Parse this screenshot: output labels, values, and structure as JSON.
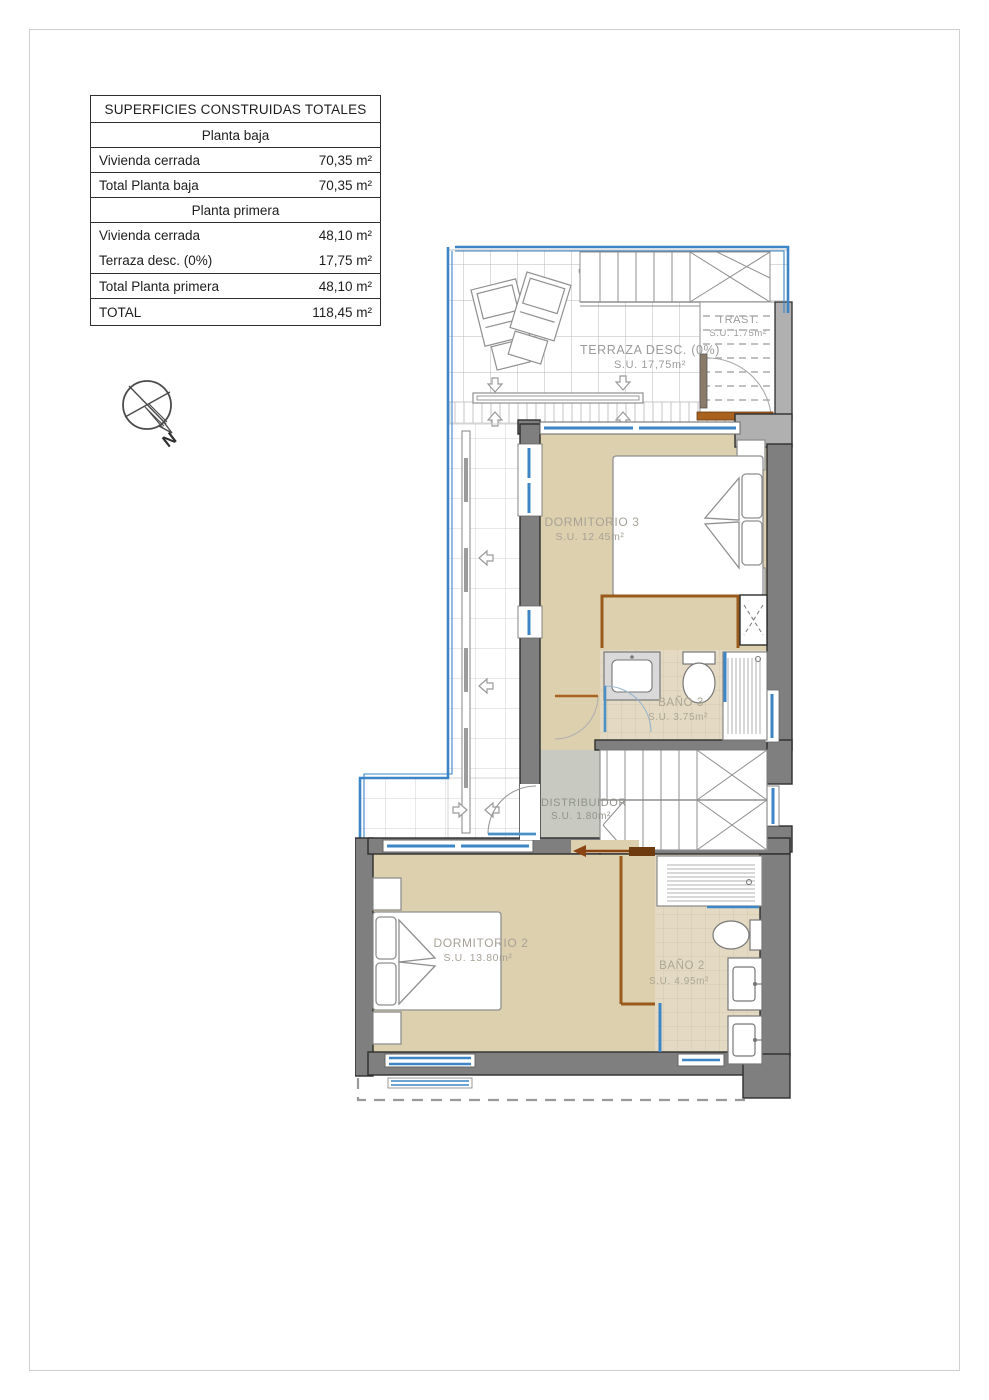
{
  "areas_table": {
    "title": "SUPERFICIES CONSTRUIDAS TOTALES",
    "planta_baja": {
      "header": "Planta baja",
      "rows": [
        {
          "label": "Vivienda cerrada",
          "value": "70,35 m²"
        },
        {
          "label": "Total Planta baja",
          "value": "70,35 m²"
        }
      ]
    },
    "planta_primera": {
      "header": "Planta primera",
      "rows": [
        {
          "label": "Vivienda cerrada",
          "value": "48,10 m²"
        },
        {
          "label": "Terraza desc. (0%)",
          "value": "17,75 m²"
        },
        {
          "label": "Total Planta primera",
          "value": "48,10 m²"
        }
      ]
    },
    "total": {
      "label": "TOTAL",
      "value": "118,45 m²"
    }
  },
  "compass": {
    "north_label": "N"
  },
  "rooms": {
    "terraza": {
      "name": "TERRAZA DESC. (0%)",
      "area": "S.U. 17,75m²"
    },
    "trastero": {
      "name": "TRAST.",
      "area": "S.U. 1.75m²"
    },
    "dormitorio3": {
      "name": "DORMITORIO 3",
      "area": "S.U. 12.45m²"
    },
    "bano3": {
      "name": "BAÑO 3",
      "area": "S.U. 3.75m²"
    },
    "distribuidor": {
      "name": "DISTRIBUIDOR",
      "area": "S.U. 1.80m²"
    },
    "dormitorio2": {
      "name": "DORMITORIO 2",
      "area": "S.U. 13.80m²"
    },
    "bano2": {
      "name": "BAÑO 2",
      "area": "S.U. 4.95m²"
    }
  },
  "colors": {
    "window_blue": "#3c85c6",
    "door_brown": "#a9611f",
    "wall_dark": "#7f7f7f",
    "wall_light": "#b0b0b0",
    "room_fill": "#ddd0ae",
    "tile_fill": "#e4dac3",
    "hall_fill": "#c8cac1"
  }
}
